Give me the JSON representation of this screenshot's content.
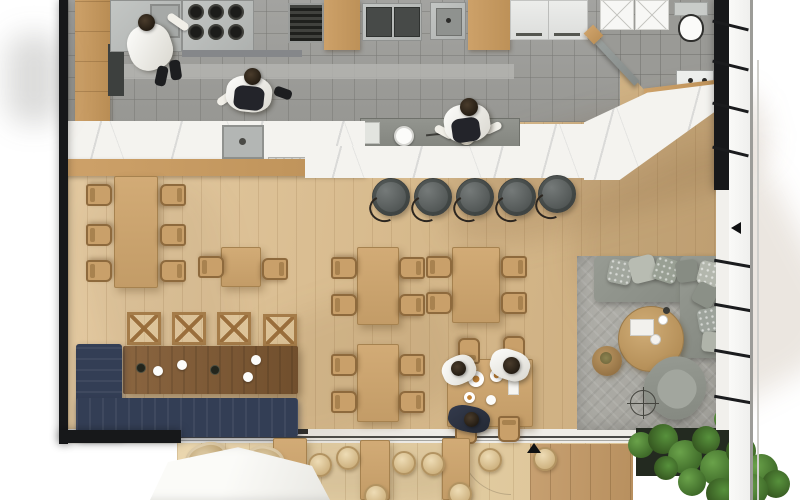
{
  "title": "Restaurant interior floor plan – top-down 3D render",
  "palette": {
    "wall": "#17181a",
    "floor-wood-light": "#e2c89f",
    "floor-wood-deep": "#cbac7e",
    "terrace-wood": "#e6d2ab",
    "terrace-wood-dark": "#c29a6c",
    "kitchen-tile": "#9c9c98",
    "marble": "#f4f3ef",
    "stainless": "#b7bab8",
    "cabinet-wood": "#c59a63",
    "table-wood": "#cba36e",
    "walnut": "#7e5c3b",
    "navy-sofa": "#333e55",
    "lounge-sofa": "#8e918a",
    "rug": "#a9a8a2",
    "stool-dark": "#5b605f",
    "rattan": "#cdb88f",
    "plant-green": "#4d7d33"
  },
  "rooms": {
    "kitchen": {
      "label": "Commercial kitchen",
      "staff_count": 3,
      "equipment": [
        "prep counter with sink",
        "six-burner stove",
        "char grill",
        "double fryer",
        "wash sink",
        "tall wood cabinets",
        "white upper cabinets"
      ]
    },
    "bathroom": {
      "label": "Restroom",
      "fixtures": [
        "toilet",
        "vanity sink",
        "x-front storage cabinet",
        "angled entry door"
      ]
    },
    "bar": {
      "label": "Marble bar counter",
      "bar_stools": 5,
      "features": [
        "integrated prep sink",
        "grey stone service top with plated dishes",
        "stepped marble end"
      ]
    },
    "dining": {
      "label": "Dining area",
      "six_seat_tables": 1,
      "two_seat_tables": 1,
      "four_seat_tables": 4,
      "x_back_stools": 4,
      "banquette": "navy L-shaped sofa with dark walnut communal table",
      "guests_dining": 3
    },
    "lounge": {
      "label": "Lounge corner",
      "furniture": [
        "grey L-shaped sectional sofa",
        "8 throw pillows",
        "round wood coffee table",
        "round side table",
        "swivel armchair",
        "herringbone grey rug",
        "compass floor decor"
      ]
    },
    "terrace": {
      "label": "Outdoor terrace",
      "furniture": [
        "white parasol",
        "2 rattan lounge chairs",
        "3 tall wood tables",
        "8 round woven stools",
        "dark planter with greenery"
      ]
    }
  },
  "architecture": {
    "walls": "black poché walls on left, bottom-left and upper-right",
    "window_wall": "full-height glazing with open casements along right side",
    "sliding_door": "glass slider between dining room and terrace",
    "markers": [
      "up-triangle at terrace threshold",
      "left-triangle at right window wall"
    ]
  }
}
